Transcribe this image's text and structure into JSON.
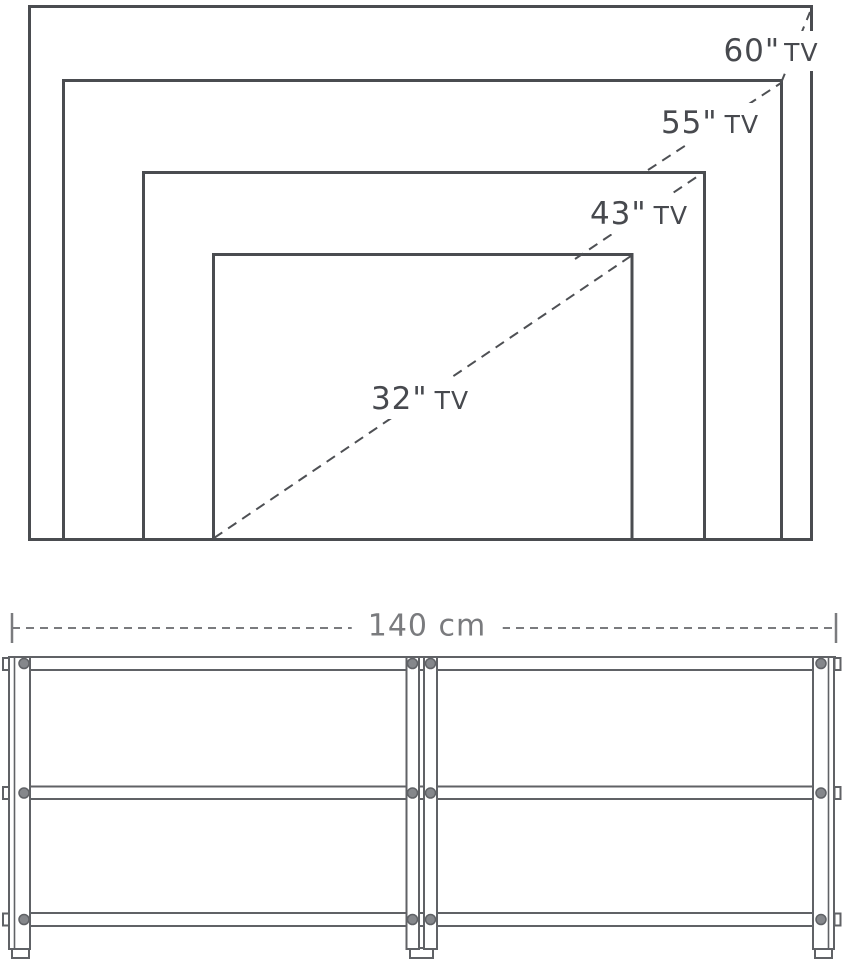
{
  "tv_size_diagram": {
    "labels": [
      {
        "size": "60\"",
        "device": "TV"
      },
      {
        "size": "55\"",
        "device": "TV"
      },
      {
        "size": "43\"",
        "device": "TV"
      },
      {
        "size": "32\"",
        "device": "TV"
      }
    ]
  },
  "stand_diagram": {
    "width_label": "140 cm"
  },
  "colors": {
    "outline": "#4a4c50",
    "stand_line": "#606266",
    "dash_line": "#4e5054",
    "label_text": "#47494e",
    "dimension_text": "#7a7b7e",
    "screw_fill": "#85878b",
    "background": "#ffffff"
  }
}
